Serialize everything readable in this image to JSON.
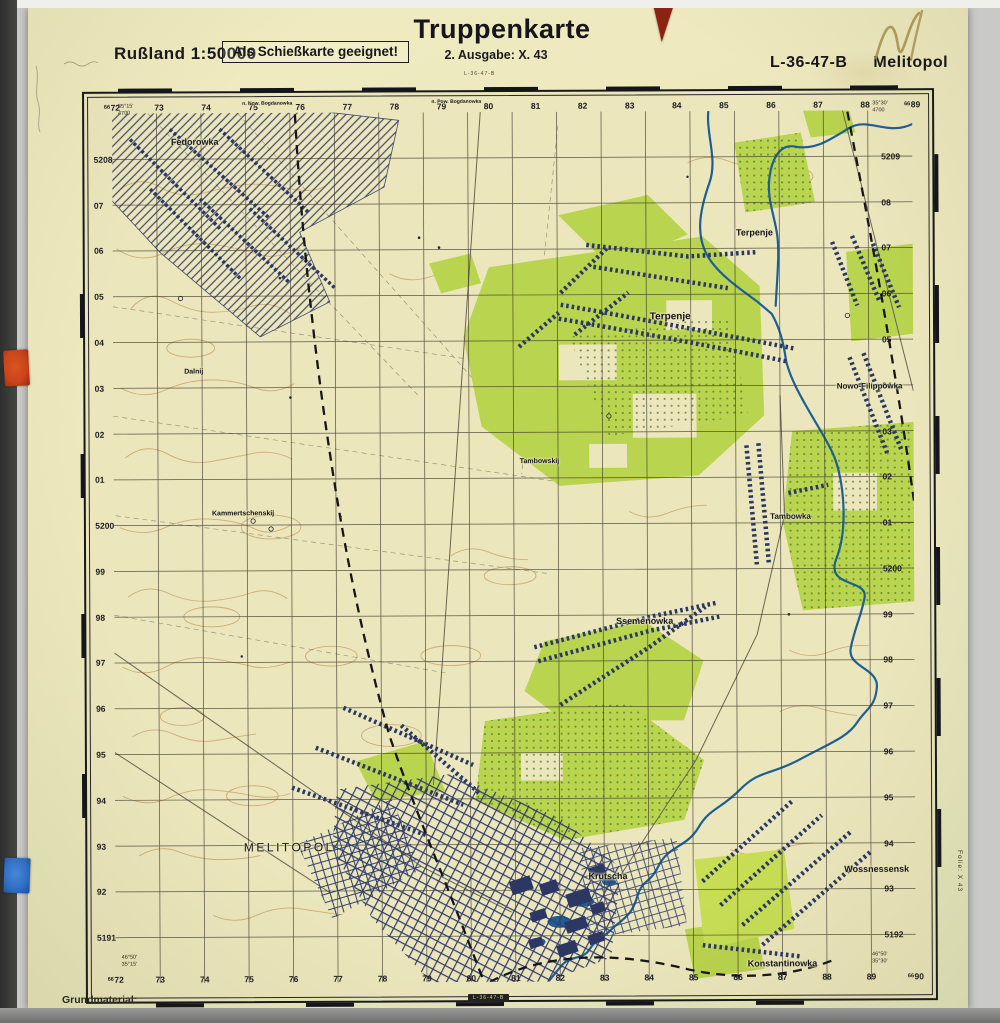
{
  "header": {
    "country_scale": "Rußland 1:50000",
    "suitability_box": "Als Schießkarte geeignet!",
    "title": "Truppenkarte",
    "edition": "2. Ausgabe:  X. 43",
    "sheet_number": "L-36-47-B",
    "sheet_name": "Melitopol"
  },
  "footer": {
    "grundmaterial": "Grundmaterial:",
    "sheet_number_small": "L-36-47-B"
  },
  "margins": {
    "sheet_number_top": "L-36-47-B",
    "folie_note": "Folie: X 43",
    "corner_coords": {
      "top_left": [
        "35°15'",
        "4700"
      ],
      "top_right": [
        "35°30'",
        "4700"
      ],
      "bottom_left": [
        "46°50'",
        "35°15'"
      ],
      "bottom_right": [
        "46°50'",
        "35°30'"
      ]
    },
    "grid_labels": {
      "top": [
        "66 72",
        "73",
        "74",
        "75",
        "76",
        "77",
        "78",
        "79",
        "80",
        "81",
        "82",
        "83",
        "84",
        "85",
        "86",
        "87",
        "88",
        "66 89"
      ],
      "bottom": [
        "66 72",
        "73",
        "74",
        "75",
        "76",
        "77",
        "78",
        "79",
        "80",
        "81",
        "82",
        "83",
        "84",
        "85",
        "86",
        "87",
        "88",
        "89",
        "66 90"
      ],
      "left": [
        "5208",
        "07",
        "06",
        "05",
        "04",
        "03",
        "02",
        "01",
        "5200",
        "99",
        "98",
        "97",
        "96",
        "95",
        "94",
        "93",
        "92",
        "5191"
      ],
      "right": [
        "5209",
        "08",
        "07",
        "06",
        "05",
        "04",
        "03",
        "02",
        "01",
        "5200",
        "99",
        "98",
        "97",
        "96",
        "95",
        "94",
        "93",
        "5192"
      ]
    }
  },
  "map_labels": [
    {
      "text": "Fedorowka",
      "x": 105,
      "y": 43,
      "size": 9
    },
    {
      "text": "n. Now. Bogdanowka",
      "x": 178,
      "y": 5,
      "size": 5
    },
    {
      "text": "n. Pow. Bogdanowka",
      "x": 368,
      "y": 4,
      "size": 5
    },
    {
      "text": "Terpenje",
      "x": 667,
      "y": 137,
      "size": 9
    },
    {
      "text": "Terpenje",
      "x": 582,
      "y": 221,
      "size": 10
    },
    {
      "text": "Nowo-Filippowka",
      "x": 782,
      "y": 291,
      "size": 8
    },
    {
      "text": "Dalnij",
      "x": 103,
      "y": 274,
      "size": 7
    },
    {
      "text": "Tambowskij",
      "x": 450,
      "y": 366,
      "size": 7
    },
    {
      "text": "Kammertschenskij",
      "x": 152,
      "y": 417,
      "size": 7
    },
    {
      "text": "Tambowka",
      "x": 702,
      "y": 422,
      "size": 8
    },
    {
      "text": "Ssemenowka",
      "x": 555,
      "y": 526,
      "size": 9
    },
    {
      "text": "MELITOPOL",
      "x": 197,
      "y": 752,
      "size": 12,
      "caps": true
    },
    {
      "text": "Krutscha",
      "x": 517,
      "y": 782,
      "size": 9
    },
    {
      "text": "Wossnessensk",
      "x": 787,
      "y": 776,
      "size": 9
    },
    {
      "text": "Konstantinowka",
      "x": 692,
      "y": 871,
      "size": 9
    }
  ],
  "colors": {
    "paper": "#ece7bd",
    "map_field": "#ebe6bc",
    "contour_brown": "#c3975a",
    "vegetation_green": "#b9d44e",
    "vegetation_bright": "#c7de55",
    "settlement_blue": "#2c3763",
    "river_blue": "#1e5e96",
    "grid_black": "#3a352c",
    "sticker_red": "#c8431a",
    "sticker_blue": "#2e6ec2",
    "triangle_red": "#8a2312",
    "pencil_mark": "#a5904a"
  }
}
